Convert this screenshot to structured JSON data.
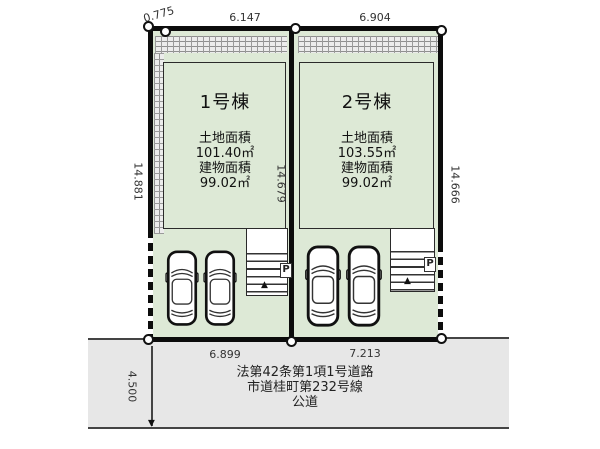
{
  "diagram_title": "2-lot housing site plan",
  "colors": {
    "lot_fill": "#dde9d6",
    "road_fill": "#e7e7e7",
    "boundary": "#0c0c0c"
  },
  "dimensions": {
    "top_corner": "0.775",
    "top_lot1": "6.147",
    "top_lot2": "6.904",
    "left_side": "14.881",
    "middle_side": "14.679",
    "right_side": "14.666",
    "bottom_lot1": "6.899",
    "bottom_lot2": "7.213",
    "road_depth": "4.500"
  },
  "lot1": {
    "name": "1号棟",
    "land_area_label": "土地面積",
    "land_area_value": "101.40㎡",
    "building_area_label": "建物面積",
    "building_area_value": "99.02㎡",
    "parking_label": "P",
    "entrance_marker": "▲"
  },
  "lot2": {
    "name": "2号棟",
    "land_area_label": "土地面積",
    "land_area_value": "103.55㎡",
    "building_area_label": "建物面積",
    "building_area_value": "99.02㎡",
    "parking_label": "P",
    "entrance_marker": "▲"
  },
  "road": {
    "line1": "法第42条第1項1号道路",
    "line2": "市道桂町第232号線",
    "line3": "公道"
  }
}
